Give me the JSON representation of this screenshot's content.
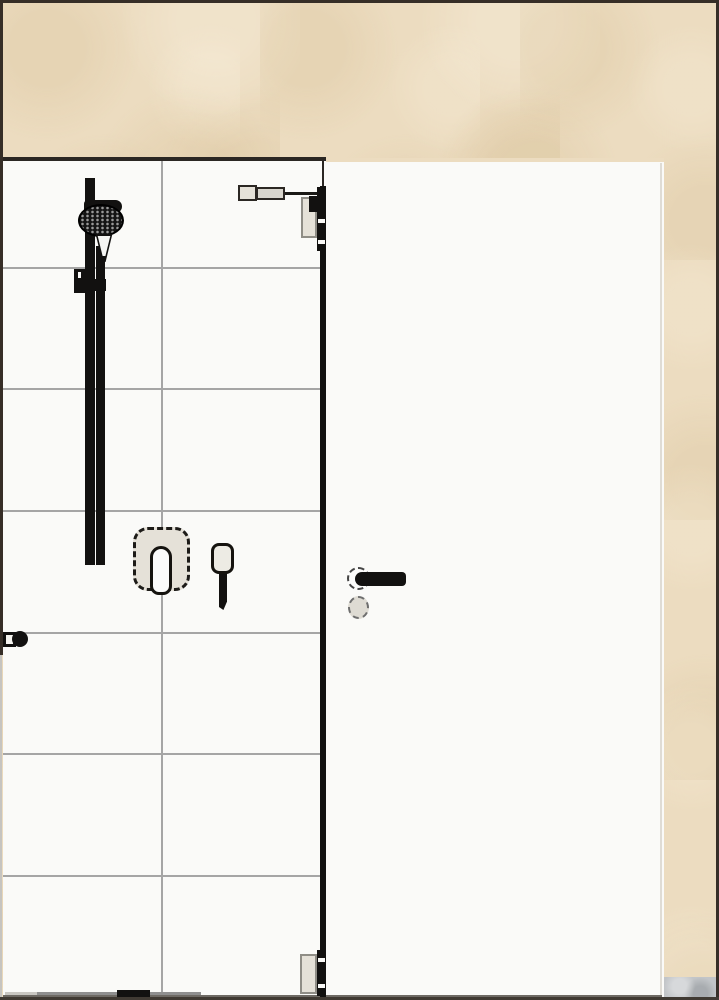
{
  "window": {
    "width": 719,
    "height": 1000,
    "title": ""
  },
  "palette": {
    "frame": "#362e27",
    "wall_beige": "#ecdcc0",
    "surface_white": "#fafaf8",
    "tile_line": "#a5a5a5",
    "outline_dark": "#2b2723",
    "fixture_black": "#121110",
    "panel_fill": "#e5e1d8",
    "panel_border": "#8f8d86",
    "rosette_fill": "#dedbd3",
    "floor_patch_gray": "#c2c5c8",
    "floor_line": "#6e6a64"
  },
  "scene": {
    "areas": {
      "wall_surround": "beige-plaster-wall",
      "shower_wall": "white-tiled-wall",
      "door_leaf": "white-door-panel",
      "floor_patch": "gray-floor-corner"
    },
    "tiles": {
      "vertical_joints": 1,
      "horizontal_joints": 6
    },
    "fixtures": [
      {
        "name": "shower-rail-set",
        "parts": [
          "rail",
          "hand-shower-head",
          "hose",
          "wall-bracket"
        ]
      },
      {
        "name": "mixer-control",
        "style": "dashed-selection-outline",
        "parts": [
          "rounded-plate",
          "lever"
        ]
      },
      {
        "name": "hand-shower-holder",
        "parts": [
          "holder-plate",
          "stem"
        ]
      },
      {
        "name": "glass-panel-edge",
        "parts": [
          "top-stabilizer-arm",
          "top-wall-bracket",
          "bottom-wall-bracket"
        ]
      },
      {
        "name": "door-handle",
        "style": "dashed-selection-outline",
        "parts": [
          "lever",
          "handle-rosette",
          "key-rosette"
        ]
      },
      {
        "name": "left-support-stub",
        "parts": [
          "plate",
          "knob"
        ]
      }
    ],
    "labels": {
      "visible_text": ""
    }
  }
}
